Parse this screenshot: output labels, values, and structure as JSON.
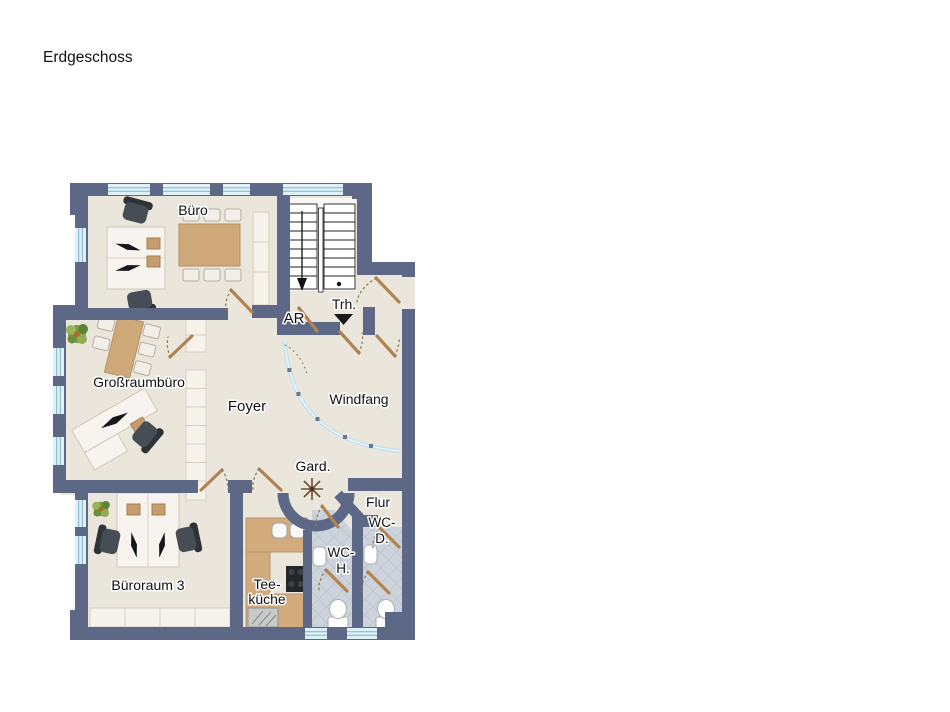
{
  "title": "Erdgeschoss",
  "floorplan": {
    "rooms": {
      "buero": {
        "label": "Büro"
      },
      "treppenhaus": {
        "label": "Trh."
      },
      "abstellraum": {
        "label": "AR"
      },
      "grossraumbuero": {
        "label": "Großraumbüro"
      },
      "foyer": {
        "label": "Foyer"
      },
      "windfang": {
        "label": "Windfang"
      },
      "garderobe": {
        "label": "Gard."
      },
      "flur": {
        "label": "Flur"
      },
      "wc_damen": {
        "label_line1": "WC-",
        "label_line2": "D."
      },
      "wc_herren": {
        "label_line1": "WC-",
        "label_line2": "H."
      },
      "bueroraum_3": {
        "label": "Büroraum 3"
      },
      "teekueche": {
        "label_line1": "Tee-",
        "label_line2": "küche"
      }
    },
    "colors": {
      "wall": "#5c6886",
      "floor": "#ebe6dc",
      "window_glass": "#dff1f8",
      "wood": "#cfa87a",
      "door_leaf": "#b28352",
      "tile": "#cdd3da",
      "chair_dark": "#474d55",
      "plant_green": "#7d9c44"
    }
  }
}
